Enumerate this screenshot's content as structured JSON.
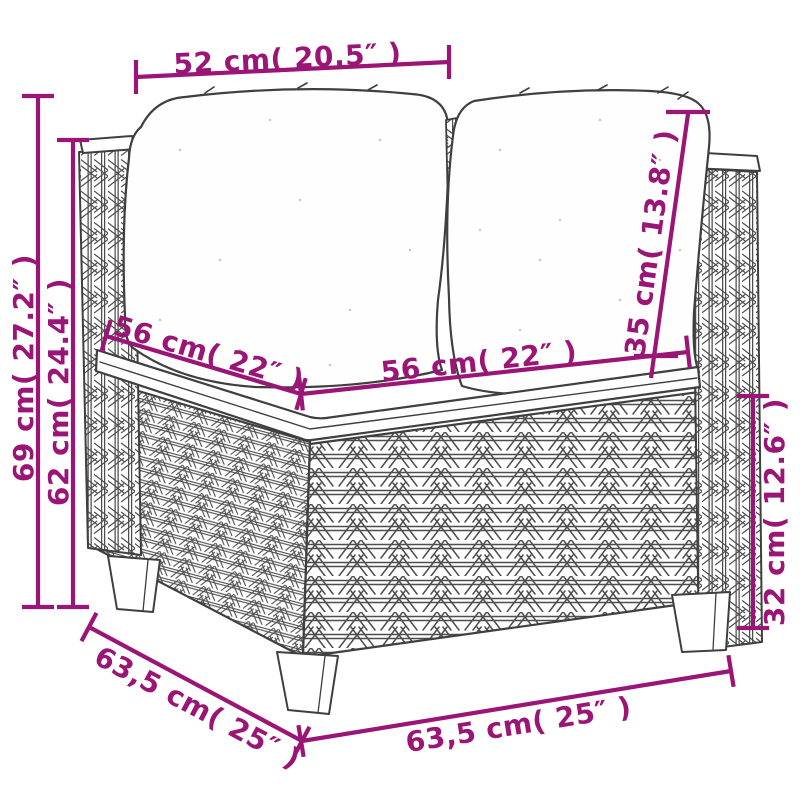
{
  "image": {
    "description": "Line-art dimension diagram of a poly rattan corner sofa section with white cushions",
    "background": "#ffffff"
  },
  "style": {
    "dimension_color": "#9B1577",
    "line_art_color": "#3F3F3F",
    "cushion_fill": "#FEFEFE"
  },
  "dimensions": [
    {
      "id": "top-width",
      "label": "52 cm( 20.5″ )"
    },
    {
      "id": "overall-height",
      "label": "69 cm( 27.2″ )"
    },
    {
      "id": "back-height",
      "label": "62 cm( 24.4″ )"
    },
    {
      "id": "seat-depth",
      "label": "56 cm( 22″ )"
    },
    {
      "id": "seat-width",
      "label": "56 cm( 22″ )"
    },
    {
      "id": "backrest-height",
      "label": "35 cm( 13.8″ )"
    },
    {
      "id": "base-height",
      "label": "32 cm( 12.6″ )"
    },
    {
      "id": "overall-depth",
      "label": "63,5 cm( 25″ )"
    },
    {
      "id": "overall-width",
      "label": "63,5 cm( 25″ )"
    }
  ]
}
